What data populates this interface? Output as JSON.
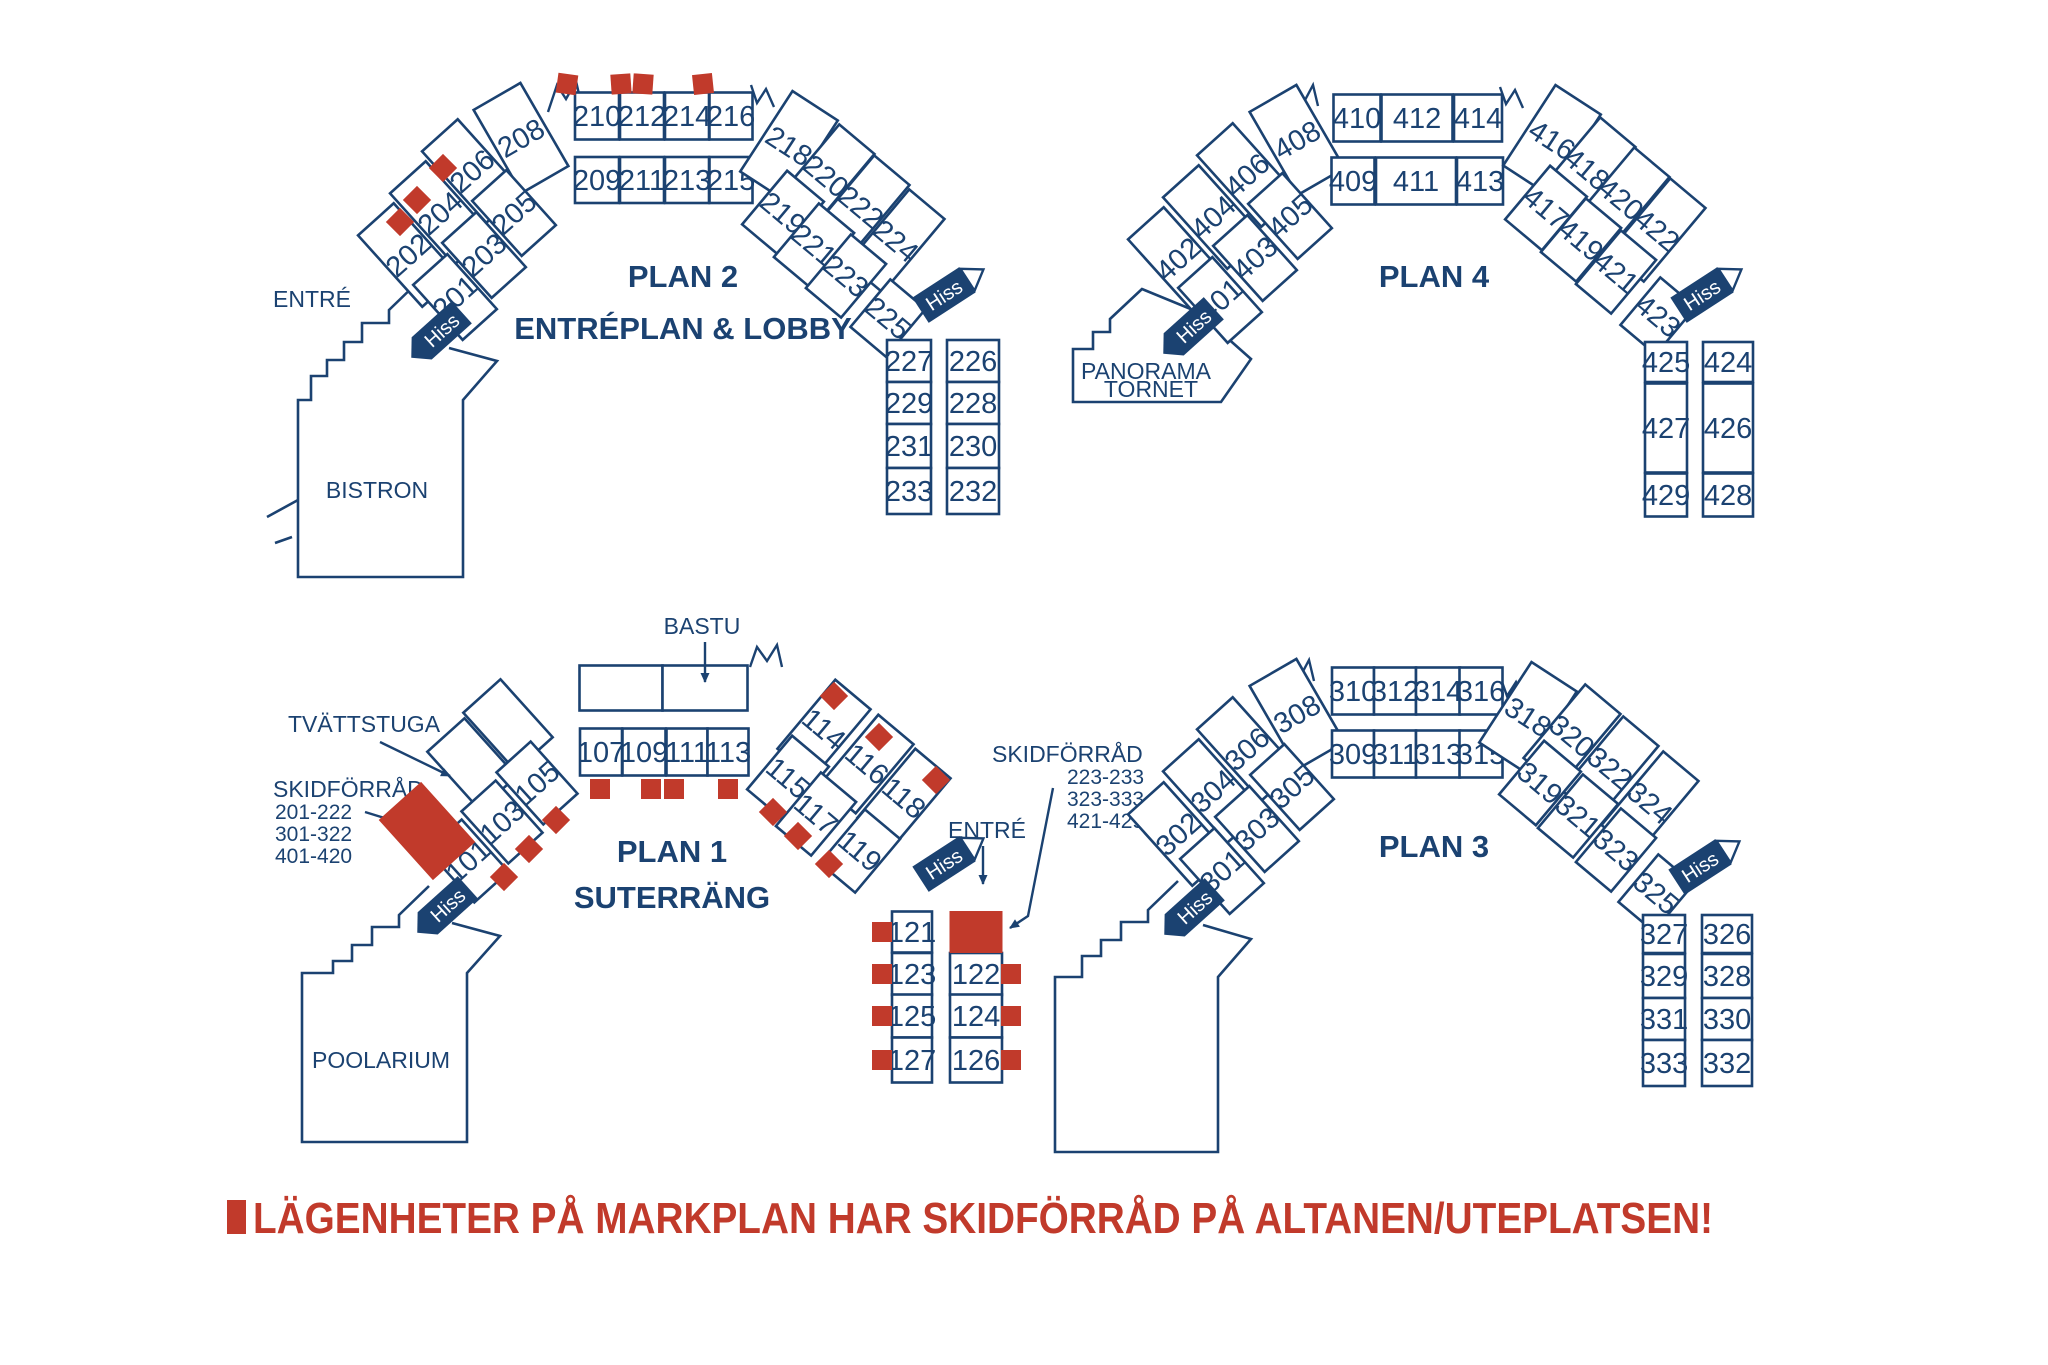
{
  "colors": {
    "navy": "#1B4271",
    "red": "#C13A2B"
  },
  "legend": {
    "text": "LÄGENHETER PÅ MARKPLAN HAR SKIDFÖRRÅD PÅ ALTANEN/UTEPLATSEN!"
  },
  "labels": {
    "hiss": "Hiss",
    "entre": "ENTRÉ",
    "bistron": "BISTRON",
    "poolarium": "POOLARIUM",
    "bastu": "BASTU",
    "tvattstuga": "TVÄTTSTUGA",
    "panorama_line1": "PANORAMA",
    "panorama_line2": "TORNET"
  },
  "skidforrad_left": {
    "title": "SKIDFÖRRÅD",
    "ranges": [
      "201-222",
      "301-322",
      "401-420"
    ]
  },
  "skidforrad_right": {
    "title": "SKIDFÖRRÅD",
    "ranges": [
      "223-233",
      "323-333",
      "421-429"
    ]
  },
  "plan2": {
    "title": "PLAN 2",
    "subtitle": "ENTRÉPLAN & LOBBY",
    "rooms": {
      "r201": "201",
      "r202": "202",
      "r203": "203",
      "r204": "204",
      "r205": "205",
      "r206": "206",
      "r208": "208",
      "r209": "209",
      "r210": "210",
      "r211": "211",
      "r212": "212",
      "r213": "213",
      "r214": "214",
      "r215": "215",
      "r216": "216",
      "r218": "218",
      "r219": "219",
      "r220": "220",
      "r221": "221",
      "r222": "222",
      "r223": "223",
      "r224": "224",
      "r225": "225",
      "r226": "226",
      "r227": "227",
      "r228": "228",
      "r229": "229",
      "r230": "230",
      "r231": "231",
      "r232": "232",
      "r233": "233"
    }
  },
  "plan4": {
    "title": "PLAN 4",
    "rooms": {
      "r401": "401",
      "r402": "402",
      "r403": "403",
      "r404": "404",
      "r405": "405",
      "r406": "406",
      "r408": "408",
      "r409": "409",
      "r410": "410",
      "r411": "411",
      "r412": "412",
      "r413": "413",
      "r414": "414",
      "r416": "416",
      "r417": "417",
      "r418": "418",
      "r419": "419",
      "r420": "420",
      "r421": "421",
      "r422": "422",
      "r423": "423",
      "r424": "424",
      "r425": "425",
      "r426": "426",
      "r427": "427",
      "r428": "428",
      "r429": "429"
    }
  },
  "plan1": {
    "title": "PLAN 1",
    "subtitle": "SUTERRÄNG",
    "rooms": {
      "r101": "101",
      "r103": "103",
      "r105": "105",
      "r107": "107",
      "r109": "109",
      "r111": "111",
      "r113": "113",
      "r114": "114",
      "r115": "115",
      "r116": "116",
      "r117": "117",
      "r118": "118",
      "r119": "119",
      "r121": "121",
      "r122": "122",
      "r123": "123",
      "r124": "124",
      "r125": "125",
      "r126": "126",
      "r127": "127"
    }
  },
  "plan3": {
    "title": "PLAN 3",
    "rooms": {
      "r301": "301",
      "r302": "302",
      "r303": "303",
      "r304": "304",
      "r305": "305",
      "r306": "306",
      "r308": "308",
      "r309": "309",
      "r310": "310",
      "r311": "311",
      "r312": "312",
      "r313": "313",
      "r314": "314",
      "r315": "315",
      "r316": "316",
      "r318": "318",
      "r319": "319",
      "r320": "320",
      "r321": "321",
      "r322": "322",
      "r323": "323",
      "r324": "324",
      "r325": "325",
      "r326": "326",
      "r327": "327",
      "r328": "328",
      "r329": "329",
      "r330": "330",
      "r331": "331",
      "r332": "332",
      "r333": "333"
    }
  }
}
